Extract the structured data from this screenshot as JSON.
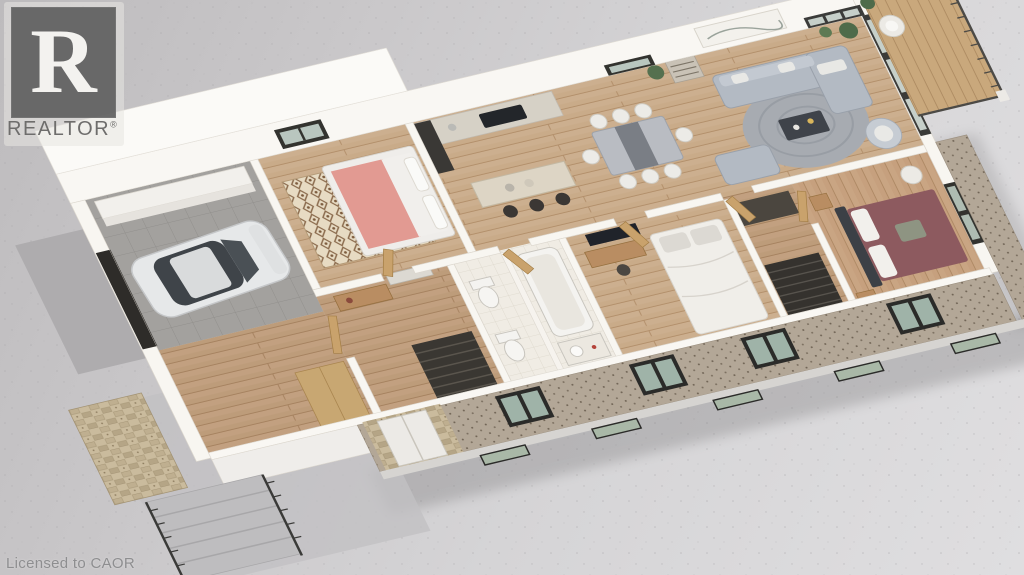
{
  "watermark": {
    "brand": "REALTOR",
    "registered_mark": "®",
    "logo_letter": "R"
  },
  "license_text": "Licensed to CAOR",
  "scene": {
    "type": "isometric 3d floor plan rendering, single storey, cutaway walls",
    "rooms": [
      "garage",
      "mudroom-hall",
      "bedroom-with-pink-bed",
      "kitchen",
      "dining-area",
      "living-room",
      "second-bedroom",
      "bathrooms",
      "closet-stairwell",
      "primary-bedroom",
      "balcony",
      "front-porch"
    ],
    "furniture": [
      "white-car",
      "wall-shelves",
      "kitchen-counter-with-cooktop",
      "kitchen-island-with-3-bar-stools",
      "dining-table-with-white-chairs",
      "gray-sectional-sofa",
      "loveseat",
      "round-rug",
      "coffee-table",
      "armchair",
      "bookshelf",
      "wall-art",
      "queen-bed-white",
      "single-bed-pink",
      "primary-bed-maroon",
      "nightstands",
      "desk-and-chair",
      "tv",
      "two-toilets",
      "bathtub",
      "vanity-sink",
      "patterned-rug",
      "deck-chair",
      "potted-plants",
      "metal-railing",
      "concrete-steps"
    ],
    "palette": {
      "background_concrete": "#cfcdd0",
      "wall_white": "#f8f6f1",
      "wood_floor": "#c9ab89",
      "brick_facade": "#b3a797",
      "garage_floor": "#a3a19e",
      "sofa_gray": "#b3bac3",
      "primary_bed_maroon": "#8d5a5f",
      "pink_bed": "#e29a92",
      "window_frame": "#33332f",
      "deck_wood": "#c9a87c",
      "stone_veneer": "#cabb9d",
      "logo_gray": "#5e5e5e"
    }
  }
}
